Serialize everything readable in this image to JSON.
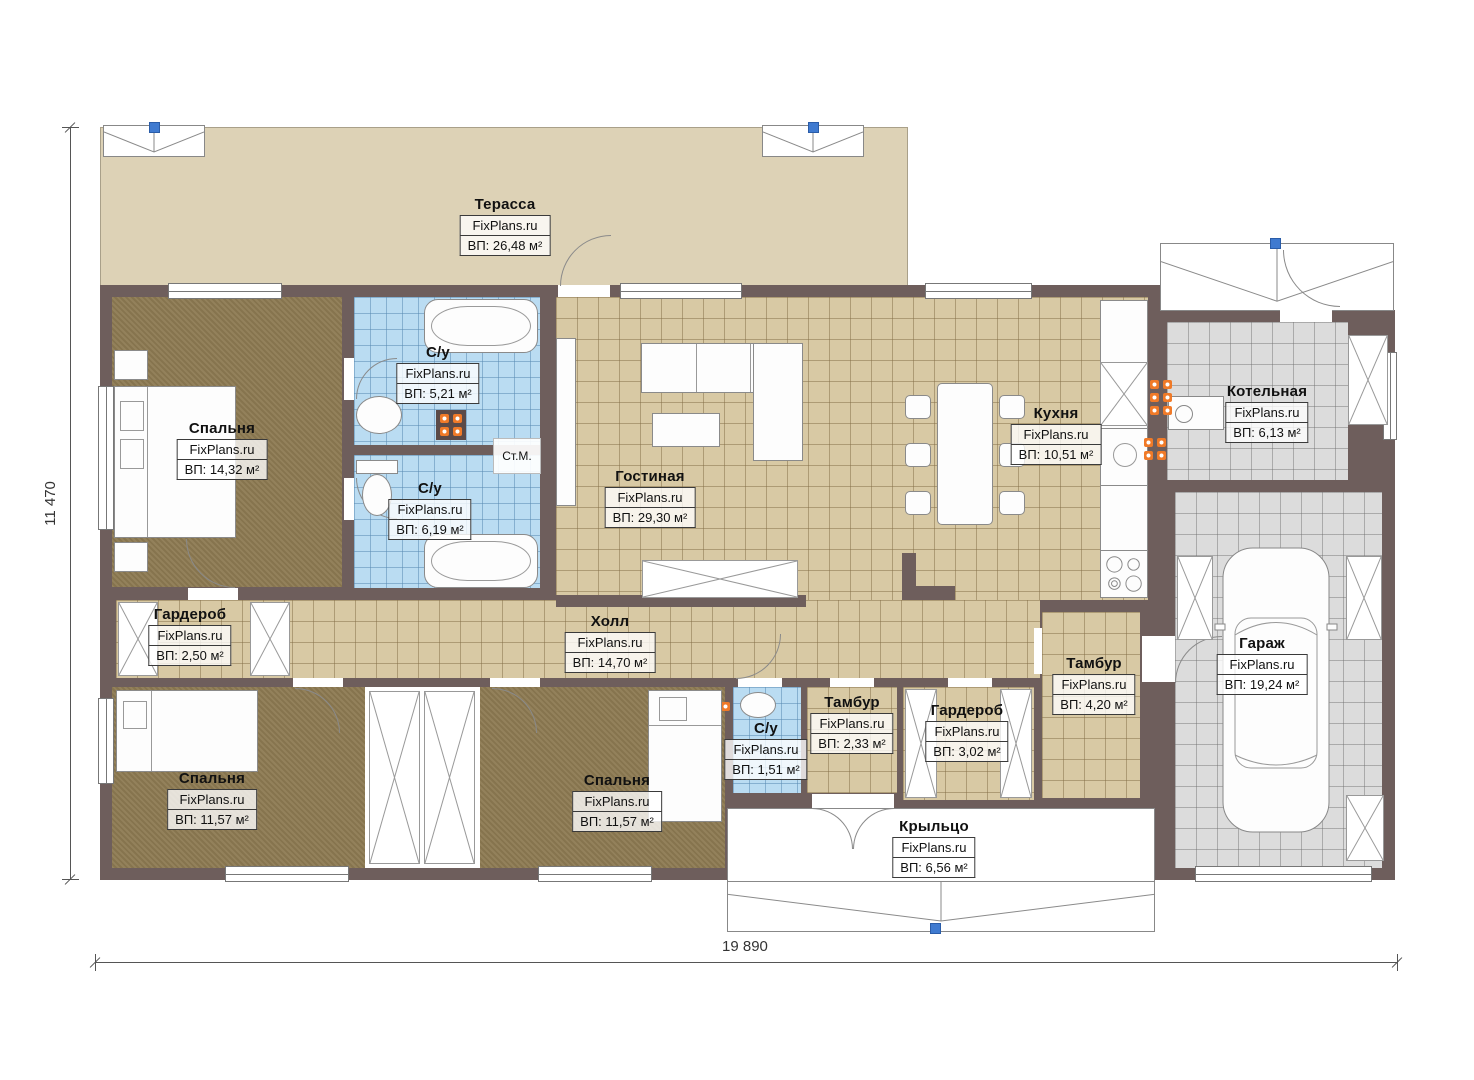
{
  "brand": "FixPlans.ru",
  "washer_label": "Ст.М.",
  "dimensions": {
    "height": "11 470",
    "width": "19 890"
  },
  "rooms": [
    {
      "name": "Терасса",
      "area": "ВП: 26,48 м²"
    },
    {
      "name": "Спальня",
      "area": "ВП: 14,32 м²"
    },
    {
      "name": "С/у",
      "area": "ВП: 5,21 м²"
    },
    {
      "name": "С/у",
      "area": "ВП: 6,19 м²"
    },
    {
      "name": "Гостиная",
      "area": "ВП: 29,30 м²"
    },
    {
      "name": "Кухня",
      "area": "ВП: 10,51 м²"
    },
    {
      "name": "Котельная",
      "area": "ВП: 6,13 м²"
    },
    {
      "name": "Гараж",
      "area": "ВП: 19,24 м²"
    },
    {
      "name": "Гардероб",
      "area": "ВП: 2,50 м²"
    },
    {
      "name": "Холл",
      "area": "ВП: 14,70 м²"
    },
    {
      "name": "С/у",
      "area": "ВП: 1,51 м²"
    },
    {
      "name": "Тамбур",
      "area": "ВП: 2,33 м²"
    },
    {
      "name": "Гардероб",
      "area": "ВП: 3,02 м²"
    },
    {
      "name": "Тамбур",
      "area": "ВП: 4,20 м²"
    },
    {
      "name": "Спальня",
      "area": "ВП: 11,57 м²"
    },
    {
      "name": "Спальня",
      "area": "ВП: 11,57 м²"
    },
    {
      "name": "Крыльцо",
      "area": "ВП: 6,56 м²"
    }
  ],
  "colors": {
    "wall": "#6e5e5c",
    "terrace": "#ddd2b6",
    "wood": "#8d7a52",
    "tile_tan": "#d8c9a4",
    "tile_blue": "#badcf2",
    "tile_gray": "#dcdcdc",
    "radiator": "#f07a28",
    "marker": "#3f7ad0"
  }
}
